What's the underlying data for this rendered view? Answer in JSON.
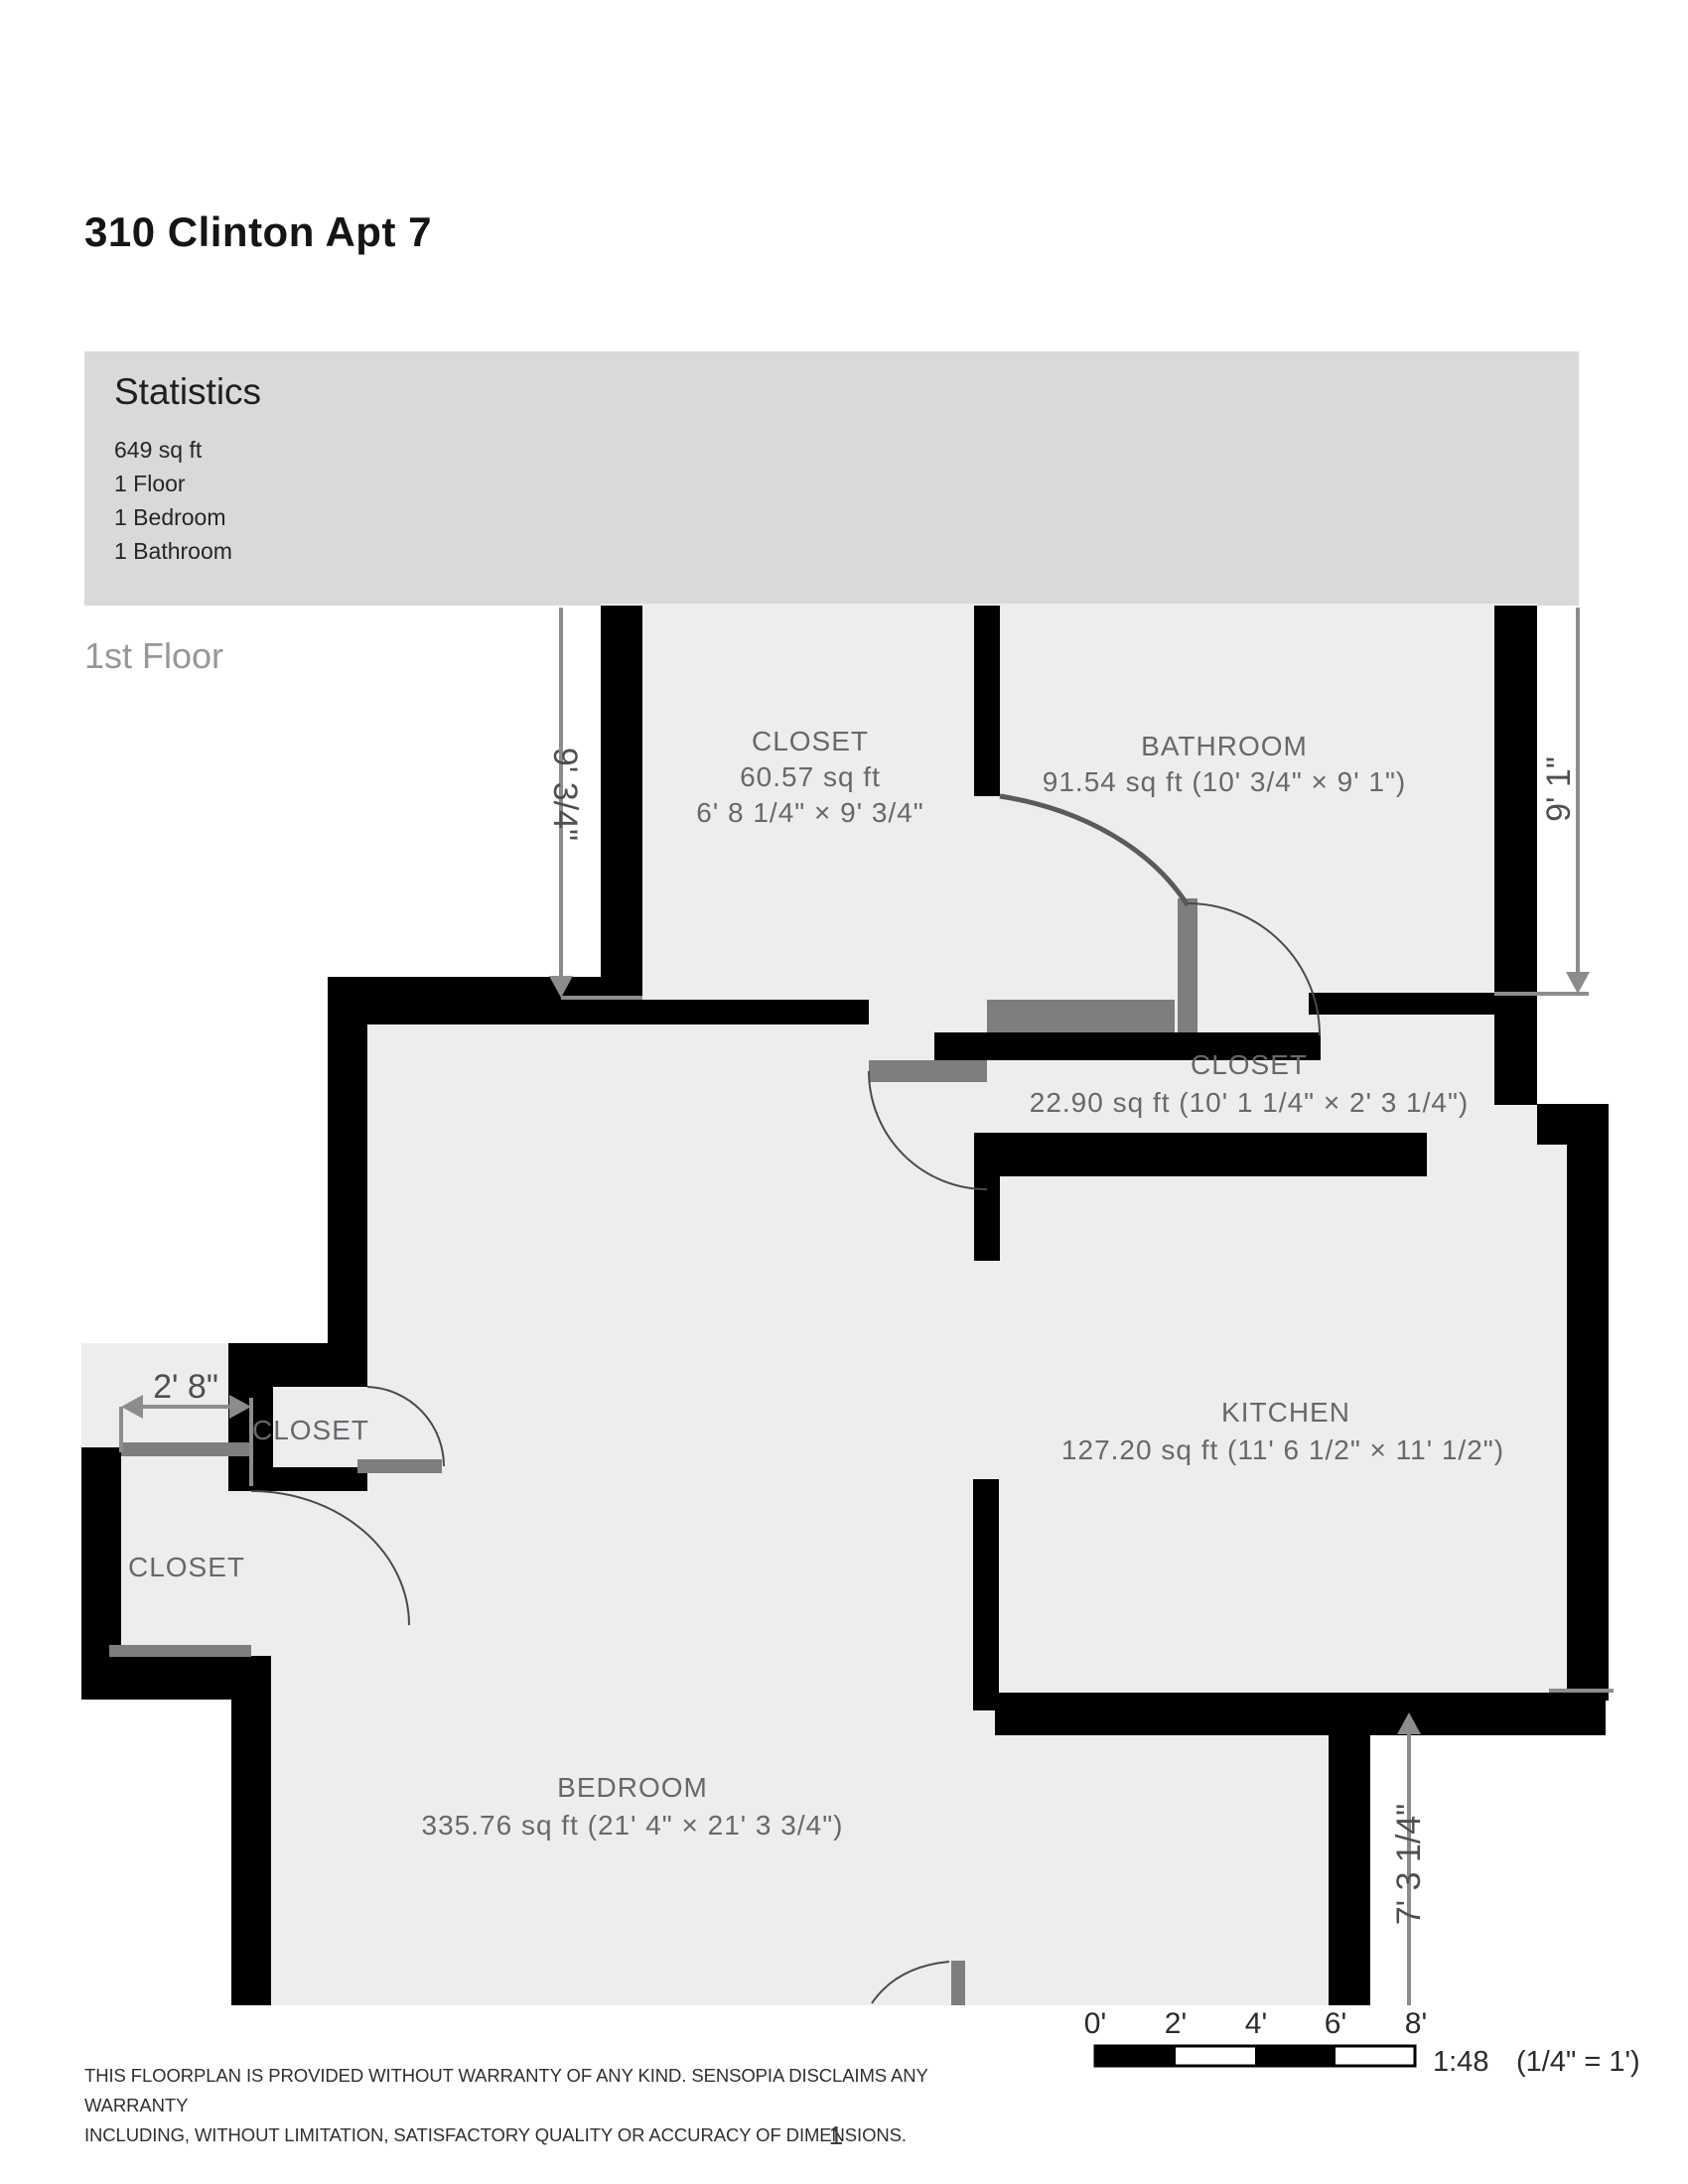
{
  "page": {
    "title": "310 Clinton Apt 7",
    "floor_label": "1st Floor",
    "page_number": "1"
  },
  "statistics": {
    "title": "Statistics",
    "items": [
      "649 sq ft",
      "1 Floor",
      "1 Bedroom",
      "1 Bathroom"
    ]
  },
  "rooms": {
    "closet_top": {
      "name": "CLOSET",
      "area": "60.57 sq ft",
      "dims": "6' 8 1/4\" × 9' 3/4\""
    },
    "bathroom": {
      "name": "BATHROOM",
      "area": "91.54 sq ft (10' 3/4\" × 9' 1\")"
    },
    "closet_hall": {
      "name": "CLOSET",
      "area": "22.90 sq ft (10' 1 1/4\" × 2' 3 1/4\")"
    },
    "kitchen": {
      "name": "KITCHEN",
      "area": "127.20 sq ft (11' 6 1/2\" × 11' 1/2\")"
    },
    "closet_small": {
      "name": "CLOSET"
    },
    "closet_lower": {
      "name": "CLOSET"
    },
    "bedroom": {
      "name": "BEDROOM",
      "area": "335.76 sq ft (21' 4\" × 21' 3 3/4\")"
    }
  },
  "dimensions": {
    "closet_height": "9' 3/4\"",
    "bathroom_height": "9' 1\"",
    "closet_width": "2' 8\"",
    "bedroom_right_height": "7' 3 1/4\""
  },
  "scale_bar": {
    "ticks": [
      "0'",
      "2'",
      "4'",
      "6'",
      "8'"
    ],
    "ratio_label": "1:48",
    "unit_label": "(1/4\" = 1')"
  },
  "disclaimer": {
    "line1": "THIS FLOORPLAN IS PROVIDED WITHOUT WARRANTY OF ANY KIND. SENSOPIA DISCLAIMS ANY WARRANTY",
    "line2": "INCLUDING, WITHOUT LIMITATION, SATISFACTORY QUALITY OR ACCURACY OF DIMENSIONS."
  },
  "colors": {
    "wall": "#000000",
    "floor": "#ededef",
    "door": "#7e7e7e",
    "dimension": "#8c8c8c",
    "statistics_bg": "#d9d9d9"
  }
}
